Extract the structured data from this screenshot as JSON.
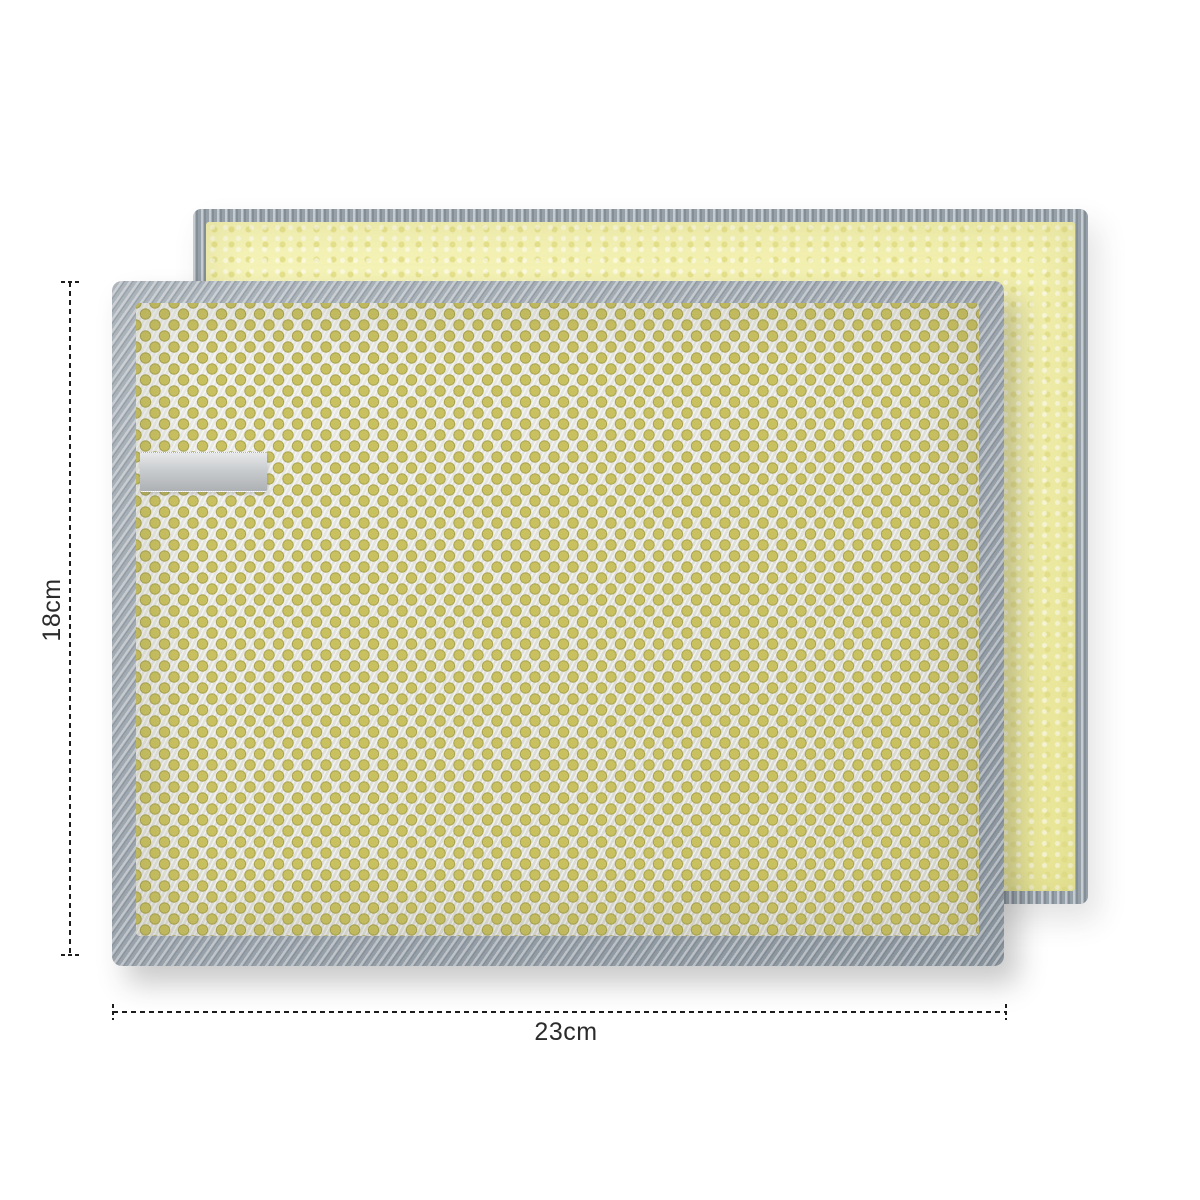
{
  "annotations": {
    "height_label": "18cm",
    "width_label": "23cm"
  },
  "product": {
    "front_pad": "silver wire-mesh scouring pad with yellow sponge showing through",
    "back_pad": "pale yellow microfiber pad with gray overlock stitched edge",
    "tag": "blank gray satin ribbon tag"
  },
  "colors": {
    "background": "#ffffff",
    "dimension-line": "#1c1c1c",
    "label-text": "#2b2b2b",
    "border-gray": "#96a0a9",
    "mesh-silver": "#e4e4e0",
    "mesh-dot": "#c9c160",
    "mesh-dot-dark": "#aaa44e",
    "sponge-yellow": "#f2efa1",
    "sponge-yellow-dark": "#e4e08b",
    "ribbon-gray": "#c9ccce"
  }
}
